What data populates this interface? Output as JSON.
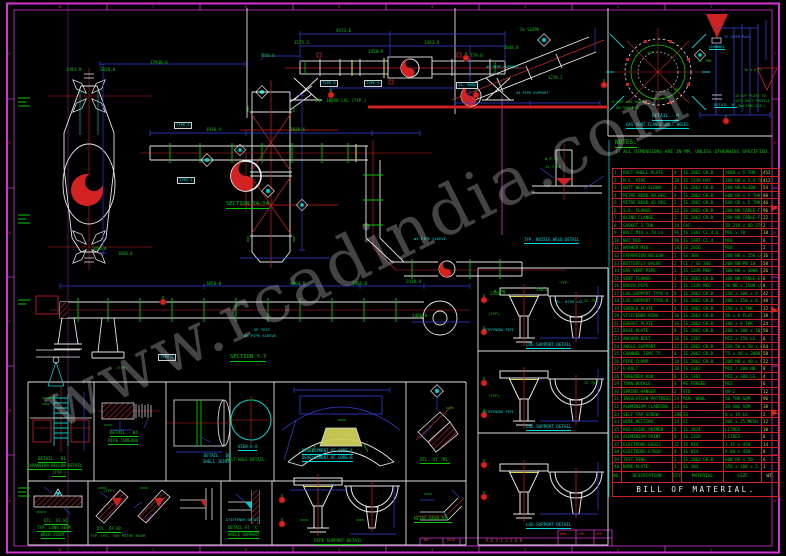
{
  "palette": {
    "green": "#00c800",
    "cyan": "#00d8d8",
    "red": "#e03434",
    "blue": "#4f6fff",
    "white": "#eeeeee",
    "yellow": "#d8d850",
    "magenta": "#e838e8",
    "watermark_gray": "#cdcdcd"
  },
  "watermark": {
    "text": "www.rcadindia.com"
  },
  "border": {
    "h_labels": [
      "8",
      "7",
      "6",
      "5",
      "4",
      "3",
      "2",
      "1"
    ],
    "v_labels": [
      "F",
      "E",
      "D",
      "C",
      "B",
      "A"
    ]
  },
  "bom": {
    "title": "BILL OF MATERIAL.",
    "headers": [
      "NO.",
      "DESCRIPTION",
      "QTY",
      "MATERIAL",
      "SIZE",
      "WT."
    ],
    "rows": [
      [
        "1",
        "DUCT SHELL PLATE",
        "4",
        "IS 2062 GR.B",
        "1600 x 5 THK",
        "452"
      ],
      [
        "2",
        "M.S. PIPE",
        "18",
        "IS 1239 HVY",
        "200 NB x 5.4 THK",
        "412"
      ],
      [
        "3",
        "BUTT WELD ELBOW",
        "6",
        "IS 2062 GR.B",
        "200 NB R=300",
        "54"
      ],
      [
        "4",
        "MITRE BEND 90 DEG",
        "4",
        "IS 2062 GR.B",
        "600 OD x 5 THK",
        "88"
      ],
      [
        "5",
        "MITRE BEND 45 DEG",
        "2",
        "IS 2062 GR.B",
        "600 OD x 5 THK",
        "46"
      ],
      [
        "6",
        "S.O. FLANGE",
        "12",
        "IS 2062 GR.B",
        "200 NB TABLE-F",
        "96"
      ],
      [
        "7",
        "BLIND FLANGE",
        "2",
        "IS 2062 GR.B",
        "200 NB TABLE-F",
        "22"
      ],
      [
        "8",
        "GASKET 3 THK",
        "14",
        "CAF",
        "ID 219 x OD 279",
        "2"
      ],
      [
        "9",
        "BOLT M16 x 70 LG",
        "96",
        "IS 1367 CL 4.6",
        "M16 x 70",
        "18"
      ],
      [
        "10",
        "NUT M16",
        "96",
        "IS 1367 CL 4",
        "M16",
        "6"
      ],
      [
        "11",
        "WASHER M16",
        "192",
        "IS 2016",
        "M16",
        "2"
      ],
      [
        "12",
        "EXPANSION BELLOW",
        "2",
        "SS 304",
        "200 NB x 150 LG",
        "16"
      ],
      [
        "13",
        "BUTTERFLY VALVE",
        "2",
        "CI / SS 304",
        "200 NB PN 10",
        "58"
      ],
      [
        "14",
        "GAS VENT PIPE",
        "1",
        "IS 1239 MED",
        "100 NB x 3000 LG",
        "26"
      ],
      [
        "15",
        "VENT FLANGE",
        "1",
        "IS 2062 GR.B",
        "100 NB TABLE-E",
        "6"
      ],
      [
        "16",
        "DRAIN PIPE",
        "1",
        "IS 1239 MED",
        "50 NB x 1500 LG",
        "8"
      ],
      [
        "17",
        "LUG SUPPORT TYPE-A",
        "8",
        "IS 2062 GR.B",
        "150 x 100 x 8 THK",
        "42"
      ],
      [
        "18",
        "LUG SUPPORT TYPE-B",
        "6",
        "IS 2062 GR.B",
        "200 x 150 x 8 THK",
        "48"
      ],
      [
        "19",
        "SADDLE PLATE",
        "6",
        "IS 2062 GR.B",
        "250 x 6 THK",
        "32"
      ],
      [
        "20",
        "STIFFENER RING",
        "10",
        "IS 2062 GR.B",
        "50 x 6 FLAT",
        "38"
      ],
      [
        "21",
        "GUSSET PLATE",
        "16",
        "IS 2062 GR.B",
        "100 x 8 THK",
        "24"
      ],
      [
        "22",
        "BASE PLATE",
        "8",
        "IS 2062 GR.B",
        "200 x 200 x 10",
        "50"
      ],
      [
        "23",
        "ANCHOR BOLT",
        "16",
        "IS 1367",
        "M12 x 150 LG",
        "6"
      ],
      [
        "24",
        "ANGLE SUPPORT",
        "12",
        "IS 2062 GR.B",
        "ISA 50 x 50 x 6",
        "64"
      ],
      [
        "25",
        "CHANNEL ISMC 75",
        "4",
        "IS 2062 GR.B",
        "75 x 40 x 2000",
        "58"
      ],
      [
        "26",
        "PIPE CLAMP",
        "10",
        "IS 2062 GR.B",
        "200 NB x 40 x 6",
        "22"
      ],
      [
        "27",
        "U-BOLT",
        "10",
        "IS 1367",
        "M12 / 200 NB",
        "8"
      ],
      [
        "28",
        "THREADED ROD",
        "8",
        "IS 1367",
        "M12 x 300 LG",
        "4"
      ],
      [
        "29",
        "TURN BUCKLE",
        "4",
        "MS FORGED",
        "M12",
        "6"
      ],
      [
        "30",
        "SPRING HANGER",
        "2",
        "STD",
        "VN-2",
        "12"
      ],
      [
        "31",
        "INSULATION MATTRESS",
        "24",
        "MIN. WOOL",
        "50 THK SQM",
        "96"
      ],
      [
        "32",
        "ALUMINIUM CLADDING",
        "24",
        "AL",
        "24 SWG SQM",
        "38"
      ],
      [
        "33",
        "SELF TAP SCREW",
        "280",
        "SS",
        "8 x 19 LG",
        "2"
      ],
      [
        "34",
        "WIRE NETTING",
        "24",
        "GI",
        "20G x 25 MESH",
        "12"
      ],
      [
        "35",
        "RED OXIDE PRIMER",
        "8",
        "IS 2074",
        "LITRES",
        "10"
      ],
      [
        "36",
        "ALUMINIUM PAINT",
        "6",
        "IS 2339",
        "LITRES",
        "8"
      ],
      [
        "37",
        "ELECTRODE E6013",
        "12",
        "IS 814",
        "3.15 x 450",
        "14"
      ],
      [
        "38",
        "ELECTRODE E7018",
        "6",
        "IS 814",
        "4.00 x 450",
        "8"
      ],
      [
        "39",
        "TEST RING",
        "2",
        "IS 2062 GR.B",
        "600 OD x 50",
        "6"
      ],
      [
        "40",
        "NAME PLATE",
        "1",
        "SS 304",
        "150 x 100 x 2",
        "1"
      ]
    ]
  },
  "labels": {
    "sections": [
      {
        "t": "SECTION Y4-Y4",
        "x": 226,
        "y": 202,
        "c": "g",
        "s": 5.5,
        "u": 1
      },
      {
        "t": "SECTION Y-Y",
        "x": 230,
        "y": 355,
        "c": "g",
        "s": 5.5,
        "u": 1
      }
    ],
    "notes": [
      {
        "t": "NOTES:",
        "x": 615,
        "y": 140,
        "c": "g",
        "s": 6,
        "u": 1
      },
      {
        "t": "1) ALL DIMENSIONS ARE IN MM, UNLESS OTHERWISE SPECIFIED.",
        "x": 615,
        "y": 151,
        "c": "g",
        "s": 4.6
      }
    ],
    "top_assembly": [
      {
        "t": "4573.6",
        "x": 336,
        "y": 29,
        "c": "g",
        "s": 4.2
      },
      {
        "t": "3175.5",
        "x": 294,
        "y": 41,
        "c": "g",
        "s": 4.2
      },
      {
        "t": "1493.9",
        "x": 424,
        "y": 41,
        "c": "g",
        "s": 4.2
      },
      {
        "t": "950.8",
        "x": 262,
        "y": 54,
        "c": "g",
        "s": 4.2
      },
      {
        "t": "1450.9",
        "x": 368,
        "y": 50,
        "c": "g",
        "s": 4.2
      },
      {
        "t": "779.8",
        "x": 470,
        "y": 54,
        "c": "g",
        "s": 4.2
      },
      {
        "t": "EL. 10058 LVL (TYP.)",
        "x": 316,
        "y": 99,
        "c": "g",
        "s": 4.2
      },
      {
        "t": "TYPE 3",
        "x": 320,
        "y": 80,
        "c": "c",
        "s": 3.6,
        "bx": 1
      },
      {
        "t": "TYPE 3",
        "x": 364,
        "y": 80,
        "c": "c",
        "s": 3.6,
        "bx": 1
      }
    ],
    "sloped_pipe": [
      {
        "t": "2% SLOPE",
        "x": 520,
        "y": 28,
        "c": "g",
        "s": 4
      },
      {
        "t": "3048.8",
        "x": 504,
        "y": 46,
        "c": "g",
        "s": 4
      },
      {
        "t": "1219.2",
        "x": 548,
        "y": 76,
        "c": "g",
        "s": 4
      },
      {
        "t": "40 PIPE SUPPORT",
        "x": 486,
        "y": 66,
        "c": "c",
        "s": 3.6
      },
      {
        "t": "43 PIPE SUPPORT",
        "x": 516,
        "y": 92,
        "c": "c",
        "s": 3.6
      },
      {
        "t": "EL. 9800",
        "x": 456,
        "y": 82,
        "c": "c",
        "s": 3.6,
        "bx": 1
      }
    ],
    "flange_detail": [
      {
        "t": "DETAIL - M",
        "x": 652,
        "y": 115,
        "c": "c",
        "s": 4.5,
        "u": 1
      },
      {
        "t": "GAS VENT FLANGE BOLT HOLES",
        "x": 626,
        "y": 123,
        "c": "c",
        "s": 4,
        "u": 1
      },
      {
        "t": "8 NOS ø34 HOLES",
        "x": 612,
        "y": 100,
        "c": "g",
        "s": 3.8
      },
      {
        "t": "ON 508 PCD",
        "x": 616,
        "y": 106,
        "c": "g",
        "s": 3.8
      },
      {
        "t": "45°",
        "x": 647,
        "y": 51,
        "c": "g",
        "s": 3.8
      },
      {
        "t": "45°",
        "x": 674,
        "y": 88,
        "c": "g",
        "s": 3.8
      }
    ],
    "vent_figure": [
      {
        "t": "IS SHIM RAIL",
        "x": 724,
        "y": 35,
        "c": "b",
        "s": 3.8
      },
      {
        "t": "CHANNEL",
        "x": 709,
        "y": 45,
        "c": "c",
        "s": 3.8,
        "u": 1
      },
      {
        "t": "22 THK",
        "x": 698,
        "y": 59,
        "c": "g",
        "s": 3.8
      },
      {
        "t": "DETAIL 'K'",
        "x": 714,
        "y": 103,
        "c": "c",
        "s": 3.8,
        "u": 1
      },
      {
        "t": "43 R/F PLATE TO",
        "x": 735,
        "y": 95,
        "c": "g",
        "s": 3.4
      },
      {
        "t": "SUIT DUCT PROFILE",
        "x": 735,
        "y": 100,
        "c": "g",
        "s": 3.4
      },
      {
        "t": "(BOLTING DIA.)",
        "x": 737,
        "y": 105,
        "c": "g",
        "s": 3.4
      },
      {
        "t": "50 x 6 FL",
        "x": 744,
        "y": 69,
        "c": "g",
        "s": 3.4
      }
    ],
    "vessel_area": [
      {
        "t": "1493.9",
        "x": 66,
        "y": 68,
        "c": "g",
        "s": 4.2
      },
      {
        "t": "2030.8",
        "x": 100,
        "y": 68,
        "c": "g",
        "s": 4.2
      },
      {
        "t": "17938.6",
        "x": 150,
        "y": 61,
        "c": "g",
        "s": 4.2
      },
      {
        "t": "1930.4",
        "x": 206,
        "y": 128,
        "c": "g",
        "s": 4.2
      },
      {
        "t": "3038.6",
        "x": 290,
        "y": 128,
        "c": "g",
        "s": 4.2
      },
      {
        "t": "1050.8",
        "x": 92,
        "y": 247,
        "c": "g",
        "s": 4
      },
      {
        "t": "1650.8",
        "x": 118,
        "y": 252,
        "c": "g",
        "s": 4
      },
      {
        "t": "TYPE 1",
        "x": 174,
        "y": 122,
        "c": "c",
        "s": 3.6,
        "bx": 1
      },
      {
        "t": "TYPE 1",
        "x": 177,
        "y": 177,
        "c": "c",
        "s": 3.6,
        "bx": 1
      },
      {
        "t": "TYPE 2",
        "x": 158,
        "y": 354,
        "c": "c",
        "s": 3.6,
        "bx": 1
      }
    ],
    "duct_runs": [
      {
        "t": "SP TEST",
        "x": 254,
        "y": 328,
        "c": "c",
        "s": 3.8
      },
      {
        "t": "ø5 PIPE SLEEVE",
        "x": 244,
        "y": 334,
        "c": "c",
        "s": 3.8
      },
      {
        "t": "ø5 PIPE SLEEVE",
        "x": 414,
        "y": 237,
        "c": "c",
        "s": 3.8
      },
      {
        "t": "3050.0",
        "x": 206,
        "y": 282,
        "c": "g",
        "s": 4.2
      },
      {
        "t": "4064.8",
        "x": 290,
        "y": 282,
        "c": "g",
        "s": 4.2
      },
      {
        "t": "1905.0",
        "x": 352,
        "y": 282,
        "c": "g",
        "s": 4.2
      },
      {
        "t": "2438.4",
        "x": 406,
        "y": 280,
        "c": "g",
        "s": 4.2
      },
      {
        "t": "1460.0",
        "x": 412,
        "y": 314,
        "c": "g",
        "s": 4.2
      },
      {
        "t": "1450.8",
        "x": 490,
        "y": 292,
        "c": "g",
        "s": 4.2
      },
      {
        "t": "748.0",
        "x": 536,
        "y": 288,
        "c": "g",
        "s": 4
      },
      {
        "t": "(TYP)",
        "x": 116,
        "y": 366,
        "c": "g",
        "s": 3.8
      },
      {
        "t": "EL. 8750 LVL",
        "x": 556,
        "y": 300,
        "c": "c",
        "s": 3.8
      }
    ],
    "nozzle_detail": [
      {
        "t": "W.P 2½",
        "x": 545,
        "y": 157,
        "c": "g",
        "s": 3.8
      },
      {
        "t": "12 T R6",
        "x": 545,
        "y": 165,
        "c": "g",
        "s": 3.8
      },
      {
        "t": "TYP. NOZZLE WELD DETAIL",
        "x": 524,
        "y": 238,
        "c": "c",
        "s": 4,
        "u": 1
      }
    ],
    "detail_cells_row1": [
      {
        "t": "DETAIL - B1",
        "x": 38,
        "y": 457,
        "c": "g",
        "s": 4.2,
        "u": 1
      },
      {
        "t": "EXPANSION BELLOW DETAIL",
        "x": 27,
        "y": 464,
        "c": "g",
        "s": 4,
        "u": 1
      },
      {
        "t": "(TYP.)",
        "x": 52,
        "y": 471,
        "c": "g",
        "s": 4,
        "u": 1
      },
      {
        "t": "DETAIL - B4",
        "x": 110,
        "y": 431,
        "c": "g",
        "s": 4.2,
        "u": 1
      },
      {
        "t": "PIPE THREADS",
        "x": 108,
        "y": 439,
        "c": "g",
        "s": 4.2,
        "u": 1
      },
      {
        "t": "DETAIL - B6",
        "x": 204,
        "y": 454,
        "c": "c",
        "s": 4
      },
      {
        "t": "SHELL JOINT",
        "x": 203,
        "y": 460,
        "c": "c",
        "s": 4
      },
      {
        "t": "VIEW X-X",
        "x": 238,
        "y": 445,
        "c": "c",
        "s": 4,
        "u": 1
      },
      {
        "t": "BOLT HOLE DETAIL",
        "x": 226,
        "y": 458,
        "c": "g",
        "s": 4
      },
      {
        "t": "DEVELOPMENT OF GORE-A",
        "x": 302,
        "y": 449,
        "c": "c",
        "s": 4,
        "u": 1
      },
      {
        "t": "DEVELOPMENT OF GORE-B",
        "x": 302,
        "y": 456,
        "c": "c",
        "s": 4,
        "u": 1
      },
      {
        "t": "DTL. AT 'M1'",
        "x": 420,
        "y": 458,
        "c": "g",
        "s": 4.2,
        "u": 1
      }
    ],
    "detail_cells_row2": [
      {
        "t": "DTL. OF W1",
        "x": 44,
        "y": 519,
        "c": "g",
        "s": 4,
        "u": 1
      },
      {
        "t": "TYP. LONG.SEAM",
        "x": 37,
        "y": 526,
        "c": "g",
        "s": 4,
        "u": 1
      },
      {
        "t": "WELD JOINT",
        "x": 41,
        "y": 533,
        "c": "g",
        "s": 4,
        "u": 1
      },
      {
        "t": "DTL. OF W2",
        "x": 97,
        "y": 527,
        "c": "g",
        "s": 4,
        "u": 1
      },
      {
        "t": "TYP. DTL. FOR MITRE SEAM",
        "x": 90,
        "y": 534,
        "c": "g",
        "s": 3.8
      },
      {
        "t": "STIFFENER DETAIL",
        "x": 226,
        "y": 519,
        "c": "c",
        "s": 3.6
      },
      {
        "t": "DETAIL AT 'X'",
        "x": 228,
        "y": 526,
        "c": "g",
        "s": 4,
        "u": 1
      },
      {
        "t": "ANGLE SUPPORT",
        "x": 228,
        "y": 533,
        "c": "g",
        "s": 4,
        "u": 1
      },
      {
        "t": "PIPE SUPPORT DETAIL",
        "x": 314,
        "y": 539,
        "c": "g",
        "s": 4.2,
        "u": 1
      },
      {
        "t": "MITRE BEND DTL.",
        "x": 414,
        "y": 517,
        "c": "g",
        "s": 4.2,
        "u": 1
      },
      {
        "t": "(TYP)",
        "x": 103,
        "y": 489,
        "c": "g",
        "s": 3.8
      }
    ],
    "lug_supports": [
      {
        "t": "LUG SUPPORT DETAIL",
        "x": 526,
        "y": 343,
        "c": "c",
        "s": 4.2,
        "u": 1
      },
      {
        "t": "LUG SUPPORT DETAIL",
        "x": 526,
        "y": 425,
        "c": "c",
        "s": 4.2,
        "u": 1
      },
      {
        "t": "LUG SUPPORT DETAIL",
        "x": 526,
        "y": 523,
        "c": "c",
        "s": 4.2,
        "u": 1
      },
      {
        "t": "(TYP)",
        "x": 488,
        "y": 312,
        "c": "g",
        "s": 3.8
      },
      {
        "t": "STIFFENING PIPE",
        "x": 483,
        "y": 329,
        "c": "c",
        "s": 3.4
      },
      {
        "t": "(TYP)",
        "x": 488,
        "y": 394,
        "c": "g",
        "s": 3.8
      },
      {
        "t": "STIFFENING PIPE",
        "x": 483,
        "y": 411,
        "c": "c",
        "s": 3.4
      },
      {
        "t": "IS 75C",
        "x": 584,
        "y": 299,
        "c": "g",
        "s": 3.8
      },
      {
        "t": "IS 75C",
        "x": 584,
        "y": 381,
        "c": "g",
        "s": 3.8
      },
      {
        "t": "'TYP'",
        "x": 558,
        "y": 281,
        "c": "g",
        "s": 3.8
      },
      {
        "t": "ø THK",
        "x": 494,
        "y": 289,
        "c": "g",
        "s": 3.8
      }
    ],
    "revision_strip": [
      {
        "t": "NO.",
        "x": 424,
        "y": 539,
        "c": "r",
        "s": 3.4
      },
      {
        "t": "DATE",
        "x": 447,
        "y": 539,
        "c": "r",
        "s": 3.4
      },
      {
        "t": "R E V I S I O N",
        "x": 486,
        "y": 539,
        "c": "r",
        "s": 4
      },
      {
        "t": "DRN.",
        "x": 560,
        "y": 533,
        "c": "r",
        "s": 3.2
      },
      {
        "t": "CHK.",
        "x": 578,
        "y": 533,
        "c": "r",
        "s": 3.2
      },
      {
        "t": "APP.",
        "x": 596,
        "y": 533,
        "c": "r",
        "s": 3.2
      }
    ]
  }
}
